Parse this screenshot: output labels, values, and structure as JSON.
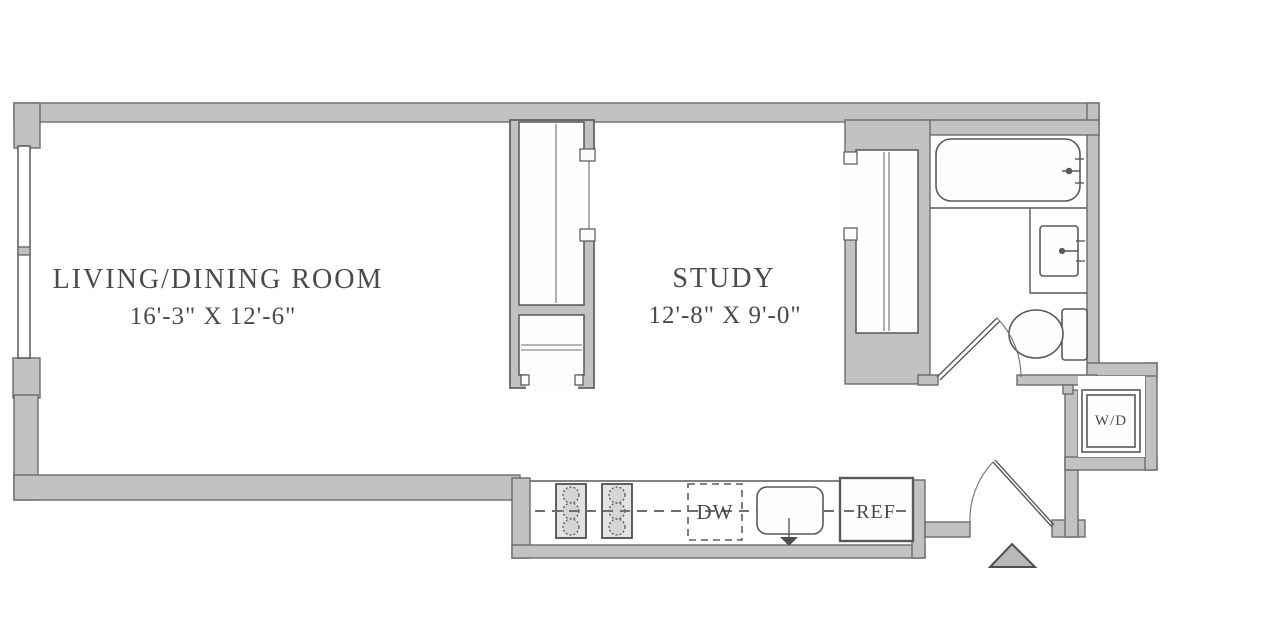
{
  "rooms": {
    "living_dining": {
      "name": "LIVING/DINING ROOM",
      "dimensions": "16'-3\" X 12'-6\""
    },
    "study": {
      "name": "STUDY",
      "dimensions": "12'-8\" X 9'-0\""
    }
  },
  "appliances": {
    "dishwasher": "DW",
    "refrigerator": "REF",
    "washer_dryer": "W/D"
  },
  "colors": {
    "wall_fill": "#c2c2c2",
    "wall_outline": "#6b6b6b",
    "fixture_line": "#5a5a5a",
    "label_text": "#4a4a4a",
    "background": "#ffffff"
  }
}
